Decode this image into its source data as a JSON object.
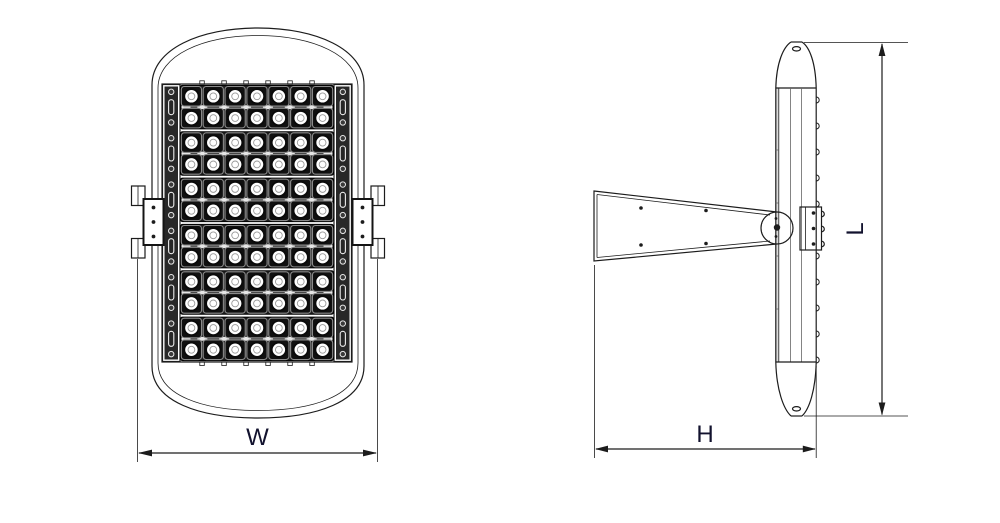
{
  "colors": {
    "background": "#ffffff",
    "line": "#1c1c1c",
    "label": "#12122e",
    "module_dark": "#1d1d1d",
    "lens": "#ffffff"
  },
  "views": {
    "front": {
      "led_modules": {
        "bands": 6,
        "rows_per_band": 2,
        "columns": 7,
        "total_leds": 84
      },
      "side_clamps": 2,
      "clamp_bolt_holes": 3
    },
    "side": {
      "fin_bumps": 11,
      "arm_holes": 4,
      "plate_bolts": 3
    }
  },
  "dimensions": {
    "width": {
      "label": "W"
    },
    "height": {
      "label": "H"
    },
    "length": {
      "label": "L"
    }
  }
}
